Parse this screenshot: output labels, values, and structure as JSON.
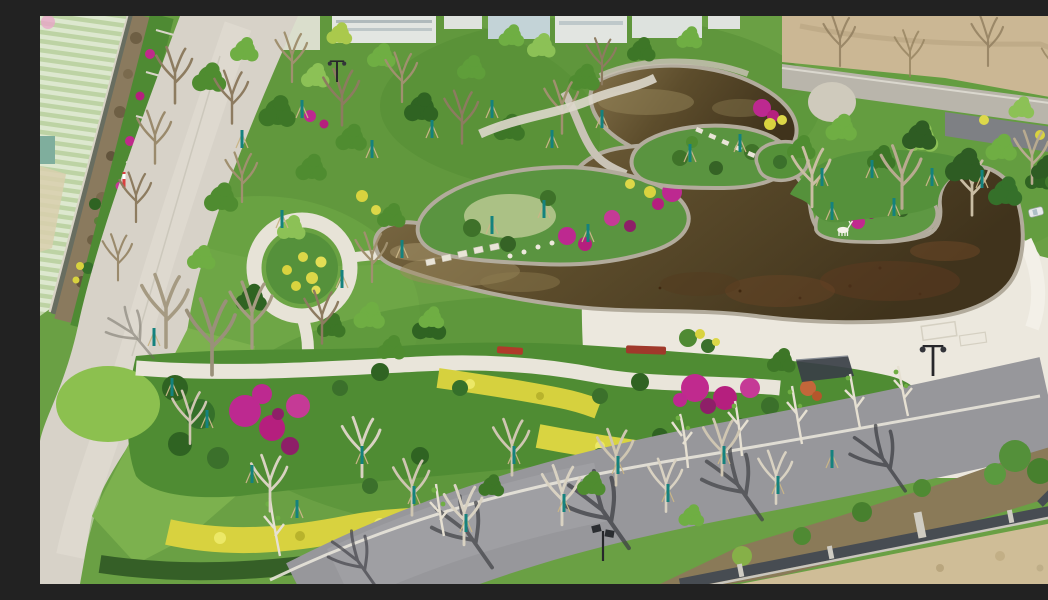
{
  "scene": {
    "title": "Aerial drone view of a newly landscaped park with a curved dark pond",
    "description": "Bird's-eye photograph of a landscape park: a curving tea-brown pond with stone-edged planting islands and stepping stones, a white deer sculpture on a peninsula, cream plaza paths, flower beds with magenta bougainvillea, golden hedge ribbons and young staked trees, a circular yellow flower bed ringed by a path, a light concrete road beside striped farmland on the left, an asphalt road with bare-tree shadows along the bottom, an iron fence and bare earth in the lower-right corner, and a dirt field with a lane of parked cars at the top right.",
    "elements": [
      "striped farmland",
      "boundary wall with brown hedgerow",
      "terraced flower beds",
      "concrete road",
      "circular yellow flower bed with ring path",
      "curved pond",
      "stone coping",
      "planting islands",
      "stepping stones",
      "zigzag stone crossing",
      "white deer sculpture",
      "peninsula garden",
      "cream plaza",
      "street lamps",
      "solar street lamp",
      "red bench",
      "dark shade canopy",
      "magenta bougainvillea clusters",
      "golden hedge ribbons",
      "chartreuse hedge",
      "dark green hedge",
      "young trees with teal trunk guards",
      "bare white-trunk trees",
      "asphalt road with tree shadows",
      "iron fence with concrete posts",
      "bare dirt corner",
      "dirt field",
      "parked cars",
      "buildings behind tree line"
    ],
    "counts": {
      "street_lamps": 3,
      "parked_cars": 4,
      "deer_sculptures": 1
    }
  },
  "palette": {
    "pond_water_dark": "#43361d",
    "pond_water_mid": "#5d4d2c",
    "pond_water_light": "#86744a",
    "stone_coping": "#b2ab9c",
    "plaza": "#ece8de",
    "concrete_road": "#d7d2c8",
    "asphalt_road": "#97979b",
    "grass_base": "#6aa044",
    "grass_bright": "#8cc04f",
    "canopy_deep": "#2f6322",
    "canopy_mid": "#4f8c30",
    "canopy_bright": "#6fae43",
    "golden_hedge": "#d8d23f",
    "magenta_flowers": "#bd2990",
    "teal_trunk_guard": "#15827e",
    "farmland": "#cfe0c2",
    "dirt": "#cbb794",
    "fence_dark": "#474c52",
    "bench_red": "#b03a2a"
  }
}
